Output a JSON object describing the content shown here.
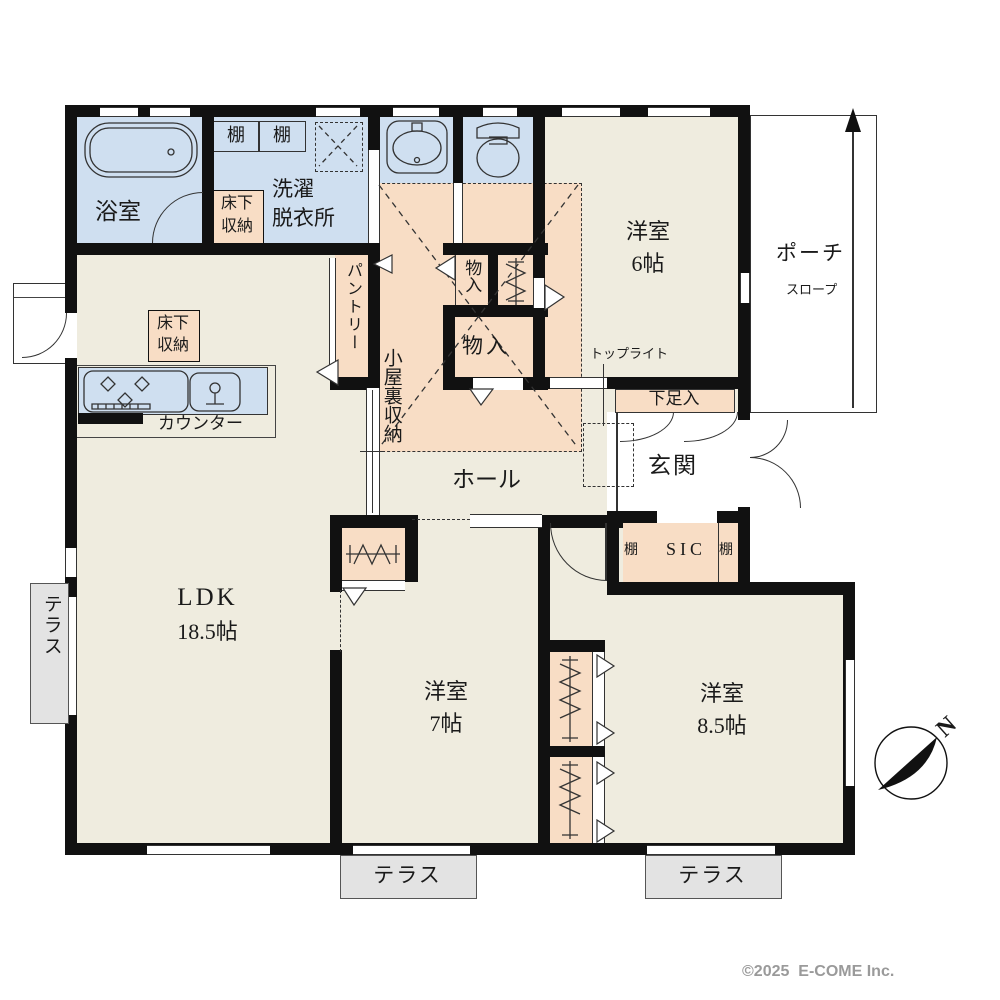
{
  "labels": {
    "bath": "浴室",
    "shelf": "棚",
    "laundry": [
      "洗濯",
      "脱衣所"
    ],
    "underfloor": [
      "床下",
      "収納"
    ],
    "pantry": "パントリー",
    "attic": "小屋裏収納",
    "closet": "物入",
    "western6": [
      "洋室",
      "6帖"
    ],
    "toplight": "トップライト",
    "shoe_cabinet": "下足入",
    "entrance": "玄関",
    "hall": "ホール",
    "sic": "SIC",
    "counter": "カウンター",
    "ldk": [
      "LDK",
      "18.5帖"
    ],
    "western7": [
      "洋室",
      "7帖"
    ],
    "western85": [
      "洋室",
      "8.5帖"
    ],
    "terrace": "テラス",
    "porch": "ポーチ",
    "slope": "スロープ",
    "north": "N",
    "copyright": "©2025  E-COME Inc."
  },
  "colors": {
    "wall": "#111111",
    "floor": "#efecdf",
    "wet_area": "#cfdff0",
    "storage": "#f8ddc5",
    "terrace": "#e3e3e3",
    "copyright_gray": "#9a9a9a"
  }
}
